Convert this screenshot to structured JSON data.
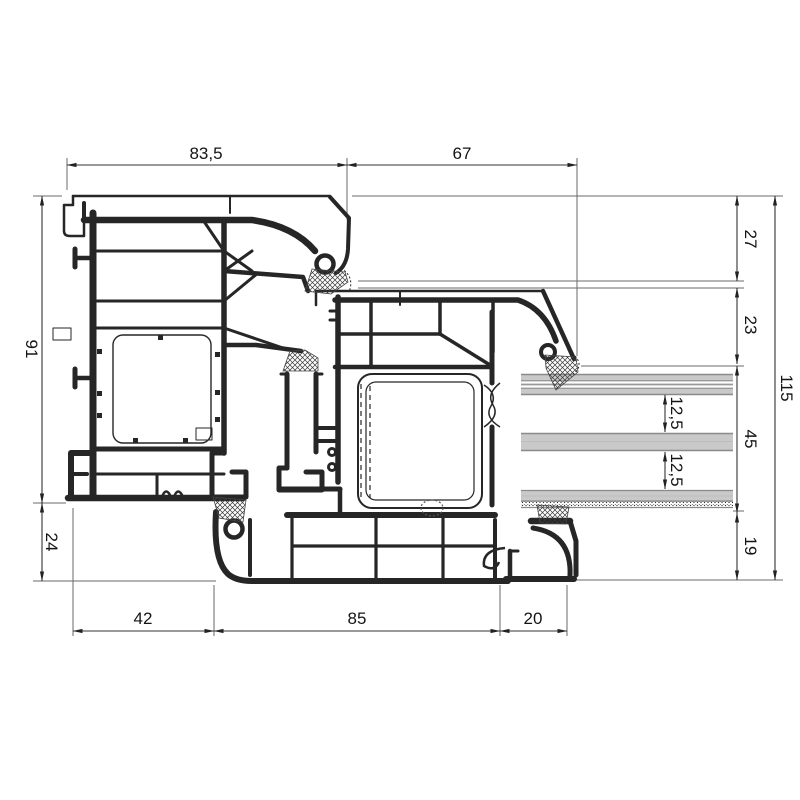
{
  "drawing": {
    "kind": "window-profile-cross-section",
    "description": "PVC window frame and sash section with triple glazing unit and glazing bead",
    "labels": {
      "top": {
        "frame_width": "83,5",
        "sash_width": "67"
      },
      "right": {
        "seg_27": "27",
        "seg_23": "23",
        "seg_45": "45",
        "seg_19": "19",
        "total_115": "115",
        "glass_gap_upper": "12,5",
        "glass_gap_lower": "12,5"
      },
      "left": {
        "frame_height_91": "91",
        "offset_24": "24"
      },
      "bottom": {
        "seg_42": "42",
        "seg_85": "85",
        "seg_20": "20"
      }
    },
    "colors": {
      "profile_line": "#262626",
      "dimension_line": "#333333",
      "glass_fill": "#c9c9c9",
      "glass_edge": "#8a8a8a",
      "background": "#ffffff"
    }
  }
}
